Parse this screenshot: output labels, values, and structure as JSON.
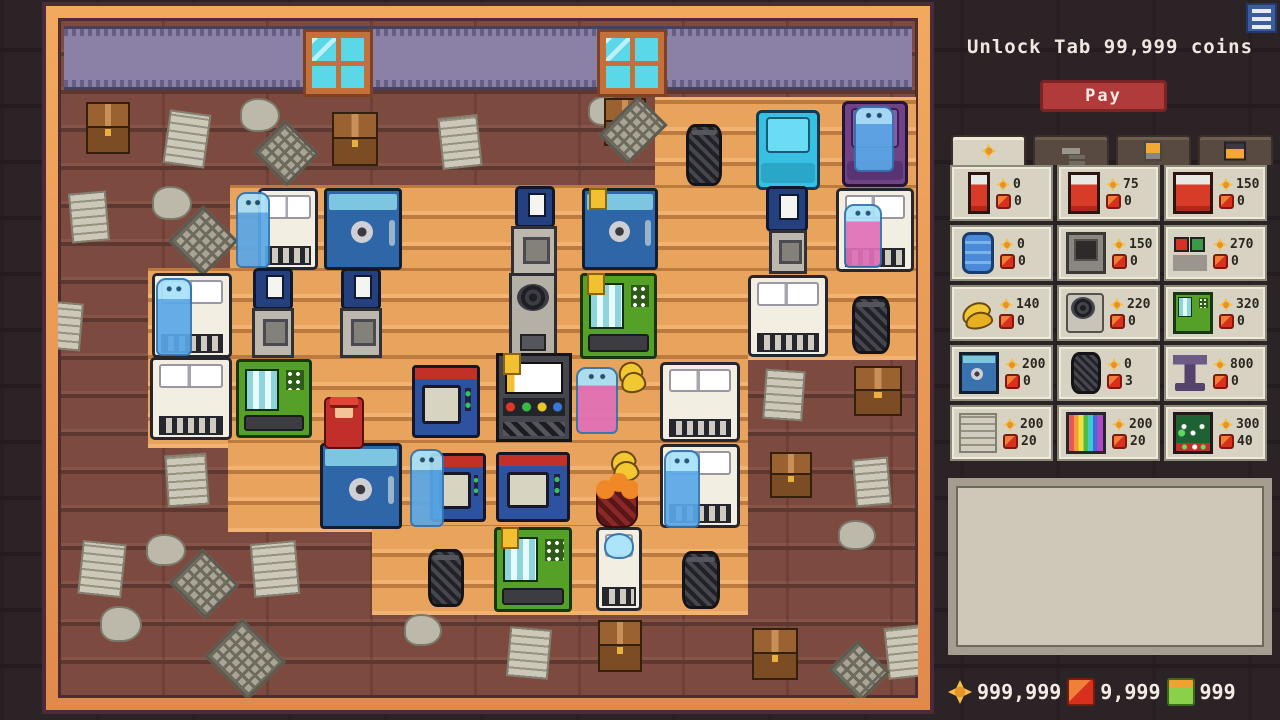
{
  "header": {
    "unlock_text": "Unlock Tab 99,999 coins",
    "pay_label": "Pay"
  },
  "colors": {
    "frame_orange": "#e8914f",
    "wall_brick": "#7d4a40",
    "floor_wood": "#e8a35d",
    "band_purple": "#8b80a6",
    "pay_red": "#b13b3b",
    "panel_beige": "#d8d2c2",
    "coin_gold": "#f6c143",
    "ruby_red": "#d8301c",
    "gem_green": "#8ad048"
  },
  "shop": {
    "tabs": [
      {
        "name": "coins-tab",
        "icon": "coin",
        "active": true
      },
      {
        "name": "tools-tab",
        "icon": "hammer",
        "active": false
      },
      {
        "name": "drinks-tab",
        "icon": "cup",
        "active": false
      },
      {
        "name": "chest-tab",
        "icon": "chest",
        "active": false
      }
    ],
    "items": [
      {
        "name": "single-bed",
        "icon": "bed1",
        "coin": "0",
        "gem": "0"
      },
      {
        "name": "double-bed",
        "icon": "bed2",
        "coin": "75",
        "gem": "0"
      },
      {
        "name": "queen-bed",
        "icon": "bed3",
        "coin": "150",
        "gem": "0"
      },
      {
        "name": "mattress-stack",
        "icon": "stack",
        "coin": "0",
        "gem": "0"
      },
      {
        "name": "furnace",
        "icon": "furnace",
        "coin": "150",
        "gem": "0"
      },
      {
        "name": "game-console",
        "icon": "console",
        "coin": "270",
        "gem": "0"
      },
      {
        "name": "bananas",
        "icon": "bananas",
        "coin": "140",
        "gem": "0"
      },
      {
        "name": "fan-machine",
        "icon": "fan",
        "coin": "220",
        "gem": "0"
      },
      {
        "name": "vending-machine",
        "icon": "vend",
        "coin": "320",
        "gem": "0"
      },
      {
        "name": "safe",
        "icon": "safe",
        "coin": "200",
        "gem": "0"
      },
      {
        "name": "trash-can",
        "icon": "trash",
        "coin": "0",
        "gem": "3"
      },
      {
        "name": "pedestal",
        "icon": "pedestal",
        "coin": "800",
        "gem": "0"
      },
      {
        "name": "newspaper",
        "icon": "paper",
        "coin": "200",
        "gem": "20"
      },
      {
        "name": "tv",
        "icon": "tv",
        "coin": "200",
        "gem": "20"
      },
      {
        "name": "pool-table",
        "icon": "pool",
        "coin": "300",
        "gem": "40"
      }
    ]
  },
  "description_box": {
    "text": ""
  },
  "currencies": [
    {
      "name": "coins",
      "icon": "gold",
      "value": "999,999"
    },
    {
      "name": "rubies",
      "icon": "red",
      "value": "9,999"
    },
    {
      "name": "gems",
      "icon": "green",
      "value": "999"
    }
  ],
  "game": {
    "objects": [
      {
        "name": "window",
        "type": "window",
        "x": 306,
        "y": 30,
        "w": 64,
        "h": 62,
        "inter": false
      },
      {
        "name": "window",
        "type": "window",
        "x": 600,
        "y": 30,
        "w": 64,
        "h": 62,
        "inter": false
      },
      {
        "name": "trash-can",
        "type": "trash",
        "x": 686,
        "y": 122,
        "w": 36,
        "h": 62
      },
      {
        "name": "armchair-cyan",
        "type": "chair",
        "x": 756,
        "y": 108,
        "w": 64,
        "h": 80
      },
      {
        "name": "armchair-purple",
        "type": "chairp",
        "x": 842,
        "y": 99,
        "w": 66,
        "h": 86
      },
      {
        "name": "ghost-on-armchair",
        "type": "ghost",
        "x": 854,
        "y": 104,
        "w": 40,
        "h": 66
      },
      {
        "name": "bed-double",
        "type": "bed",
        "x": 258,
        "y": 186,
        "w": 60,
        "h": 82
      },
      {
        "name": "ghost-waving",
        "type": "ghost",
        "x": 236,
        "y": 190,
        "w": 34,
        "h": 76
      },
      {
        "name": "safe-blue",
        "type": "safe",
        "x": 324,
        "y": 186,
        "w": 78,
        "h": 82
      },
      {
        "name": "slot-machine",
        "type": "slot",
        "x": 515,
        "y": 184,
        "w": 40,
        "h": 42
      },
      {
        "name": "grey-machine",
        "type": "machine",
        "x": 511,
        "y": 224,
        "w": 46,
        "h": 50
      },
      {
        "name": "fan-machine",
        "type": "fanm",
        "x": 509,
        "y": 271,
        "w": 48,
        "h": 86
      },
      {
        "name": "safe-blue-tagged",
        "type": "safe",
        "x": 582,
        "y": 186,
        "w": 76,
        "h": 82,
        "tag": true
      },
      {
        "name": "vending-machine",
        "type": "vend",
        "x": 580,
        "y": 271,
        "w": 77,
        "h": 86,
        "tag": true
      },
      {
        "name": "slot-machine",
        "type": "slot",
        "x": 766,
        "y": 184,
        "w": 42,
        "h": 46
      },
      {
        "name": "grey-machine",
        "type": "machine",
        "x": 769,
        "y": 228,
        "w": 38,
        "h": 44
      },
      {
        "name": "bed-double",
        "type": "bed",
        "x": 836,
        "y": 186,
        "w": 78,
        "h": 84
      },
      {
        "name": "ghost-woman-pink",
        "type": "ghostp",
        "x": 844,
        "y": 202,
        "w": 38,
        "h": 64
      },
      {
        "name": "bed-double",
        "type": "bed",
        "x": 152,
        "y": 271,
        "w": 80,
        "h": 85
      },
      {
        "name": "ghost-standing",
        "type": "ghost",
        "x": 156,
        "y": 276,
        "w": 36,
        "h": 78
      },
      {
        "name": "slot-machine",
        "type": "slot",
        "x": 253,
        "y": 266,
        "w": 40,
        "h": 42
      },
      {
        "name": "grey-machine",
        "type": "machine",
        "x": 252,
        "y": 306,
        "w": 42,
        "h": 50
      },
      {
        "name": "slot-machine",
        "type": "slot",
        "x": 341,
        "y": 266,
        "w": 40,
        "h": 42
      },
      {
        "name": "grey-machine",
        "type": "machine",
        "x": 340,
        "y": 306,
        "w": 42,
        "h": 50
      },
      {
        "name": "bed-double",
        "type": "bed",
        "x": 748,
        "y": 273,
        "w": 80,
        "h": 82
      },
      {
        "name": "trash-can",
        "type": "trash",
        "x": 852,
        "y": 294,
        "w": 38,
        "h": 58
      },
      {
        "name": "bed-double",
        "type": "bed",
        "x": 150,
        "y": 355,
        "w": 82,
        "h": 83
      },
      {
        "name": "vending-machine",
        "type": "vend",
        "x": 236,
        "y": 357,
        "w": 76,
        "h": 79
      },
      {
        "name": "tv-set",
        "type": "tv",
        "x": 412,
        "y": 363,
        "w": 68,
        "h": 73
      },
      {
        "name": "arcade-machine",
        "type": "arcade",
        "x": 496,
        "y": 351,
        "w": 76,
        "h": 89,
        "tag": true
      },
      {
        "name": "ghost-woman-purple",
        "type": "ghostp",
        "x": 576,
        "y": 365,
        "w": 42,
        "h": 67
      },
      {
        "name": "bananas",
        "type": "bananas",
        "x": 616,
        "y": 355,
        "w": 28,
        "h": 38
      },
      {
        "name": "safe-blue",
        "type": "safe",
        "x": 320,
        "y": 441,
        "w": 82,
        "h": 86
      },
      {
        "name": "player-bellhop",
        "type": "player",
        "x": 324,
        "y": 395,
        "w": 40,
        "h": 52
      },
      {
        "name": "ghost-standing",
        "type": "ghost",
        "x": 410,
        "y": 447,
        "w": 34,
        "h": 78
      },
      {
        "name": "tv-set",
        "type": "tv",
        "x": 430,
        "y": 451,
        "w": 56,
        "h": 69
      },
      {
        "name": "tv-set",
        "type": "tv",
        "x": 496,
        "y": 450,
        "w": 74,
        "h": 70
      },
      {
        "name": "bananas",
        "type": "bananas",
        "x": 608,
        "y": 445,
        "w": 30,
        "h": 36
      },
      {
        "name": "orange-basket",
        "type": "oranges",
        "x": 596,
        "y": 486,
        "w": 42,
        "h": 40
      },
      {
        "name": "bed-double",
        "type": "bed",
        "x": 660,
        "y": 360,
        "w": 80,
        "h": 80
      },
      {
        "name": "bed-double",
        "type": "bed",
        "x": 660,
        "y": 442,
        "w": 80,
        "h": 84
      },
      {
        "name": "ghost-standing",
        "type": "ghost",
        "x": 664,
        "y": 448,
        "w": 36,
        "h": 78
      },
      {
        "name": "bed-single",
        "type": "beds",
        "x": 596,
        "y": 525,
        "w": 46,
        "h": 84
      },
      {
        "name": "ghost-sleeping",
        "type": "sghost",
        "x": 604,
        "y": 531,
        "w": 30,
        "h": 26
      },
      {
        "name": "vending-machine",
        "type": "vend",
        "x": 494,
        "y": 525,
        "w": 78,
        "h": 85,
        "tag": true
      },
      {
        "name": "trash-can",
        "type": "trash",
        "x": 428,
        "y": 547,
        "w": 36,
        "h": 58
      },
      {
        "name": "trash-can",
        "type": "trash",
        "x": 682,
        "y": 549,
        "w": 38,
        "h": 58
      }
    ],
    "debris": [
      {
        "type": "crate",
        "x": 86,
        "y": 100,
        "w": 44,
        "h": 52
      },
      {
        "type": "paper",
        "x": 166,
        "y": 110,
        "w": 42,
        "h": 54,
        "r": 8
      },
      {
        "type": "crumple",
        "x": 240,
        "y": 96,
        "w": 40,
        "h": 34
      },
      {
        "type": "grate",
        "x": 262,
        "y": 128,
        "w": 48,
        "h": 46
      },
      {
        "type": "crate",
        "x": 332,
        "y": 110,
        "w": 46,
        "h": 54
      },
      {
        "type": "paper",
        "x": 440,
        "y": 114,
        "w": 40,
        "h": 52,
        "r": -6
      },
      {
        "type": "crumple",
        "x": 588,
        "y": 94,
        "w": 36,
        "h": 30
      },
      {
        "type": "crate",
        "x": 604,
        "y": 96,
        "w": 42,
        "h": 48
      },
      {
        "type": "grate",
        "x": 612,
        "y": 100,
        "w": 42,
        "h": 56
      },
      {
        "type": "paper",
        "x": 70,
        "y": 190,
        "w": 38,
        "h": 50,
        "r": -5
      },
      {
        "type": "crumple",
        "x": 152,
        "y": 184,
        "w": 40,
        "h": 34
      },
      {
        "type": "grate",
        "x": 178,
        "y": 214,
        "w": 50,
        "h": 50
      },
      {
        "type": "paper",
        "x": 46,
        "y": 300,
        "w": 36,
        "h": 48,
        "r": 5
      },
      {
        "type": "paper",
        "x": 166,
        "y": 452,
        "w": 42,
        "h": 52,
        "r": -4
      },
      {
        "type": "crumple",
        "x": 146,
        "y": 532,
        "w": 40,
        "h": 32
      },
      {
        "type": "paper",
        "x": 80,
        "y": 540,
        "w": 44,
        "h": 54,
        "r": 6
      },
      {
        "type": "grate",
        "x": 178,
        "y": 558,
        "w": 52,
        "h": 48
      },
      {
        "type": "paper",
        "x": 252,
        "y": 540,
        "w": 46,
        "h": 54,
        "r": -5
      },
      {
        "type": "crumple",
        "x": 100,
        "y": 604,
        "w": 42,
        "h": 36
      },
      {
        "type": "grate",
        "x": 214,
        "y": 630,
        "w": 62,
        "h": 54
      },
      {
        "type": "crumple",
        "x": 404,
        "y": 612,
        "w": 38,
        "h": 32
      },
      {
        "type": "paper",
        "x": 508,
        "y": 626,
        "w": 42,
        "h": 50,
        "r": 5
      },
      {
        "type": "crate",
        "x": 598,
        "y": 618,
        "w": 44,
        "h": 52
      },
      {
        "type": "crate",
        "x": 752,
        "y": 626,
        "w": 46,
        "h": 52
      },
      {
        "type": "paper",
        "x": 886,
        "y": 624,
        "w": 40,
        "h": 52,
        "r": -6
      },
      {
        "type": "grate",
        "x": 836,
        "y": 648,
        "w": 46,
        "h": 42
      },
      {
        "type": "paper",
        "x": 764,
        "y": 368,
        "w": 40,
        "h": 50,
        "r": 4
      },
      {
        "type": "crate",
        "x": 854,
        "y": 364,
        "w": 48,
        "h": 50
      },
      {
        "type": "crate",
        "x": 770,
        "y": 450,
        "w": 42,
        "h": 46
      },
      {
        "type": "paper",
        "x": 854,
        "y": 456,
        "w": 36,
        "h": 48,
        "r": -5
      },
      {
        "type": "crumple",
        "x": 838,
        "y": 518,
        "w": 38,
        "h": 30
      }
    ]
  }
}
